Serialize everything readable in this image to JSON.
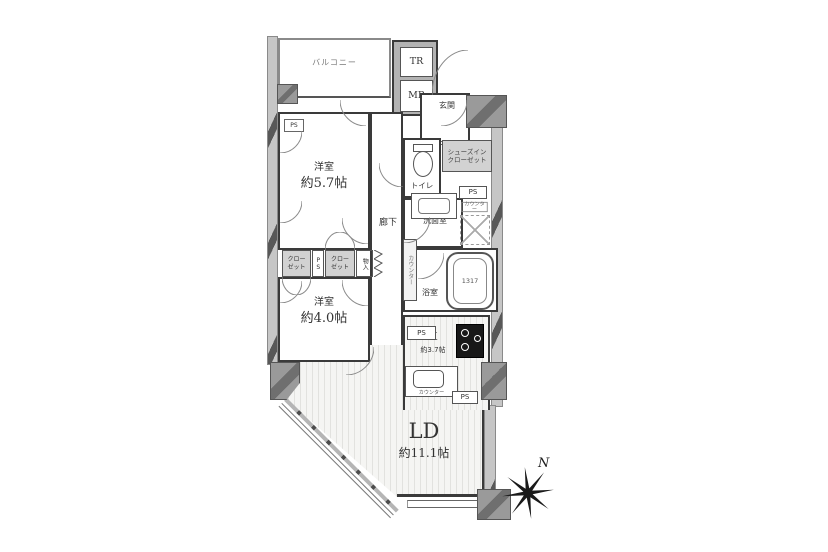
{
  "colors": {
    "wall_light": "#c6c6c6",
    "wall_dark": "#585858",
    "column": "#9a9a9a",
    "closet": "#d2d2d2",
    "line": "#3a3a3a"
  },
  "rooms": {
    "balcony": {
      "label": "バルコニー"
    },
    "shaft": {
      "tr": "TR",
      "mb": "MB"
    },
    "entrance": {
      "label": "玄関"
    },
    "toilet": {
      "label": "トイレ"
    },
    "shoes_in_closet": {
      "label": "シューズイン\nクローゼット"
    },
    "washroom": {
      "label": "洗面室",
      "counter": "カウンター"
    },
    "bathroom": {
      "label": "浴室",
      "tub_size": "1317",
      "side_counter": "カウンター"
    },
    "hallway": {
      "label": "廊下"
    },
    "bedroom1": {
      "label": "洋室",
      "size": "約5.7帖"
    },
    "bedroom2": {
      "label": "洋室",
      "size": "約4.0帖"
    },
    "closet_left": {
      "label": "クロー\nゼット"
    },
    "closet_right": {
      "label": "クロー\nゼット"
    },
    "storage": {
      "label": "物入"
    },
    "kitchen": {
      "label": "K",
      "size": "約3.7帖",
      "counter": "カウンター"
    },
    "living_dining": {
      "label": "LD",
      "size": "約11.1帖"
    }
  },
  "labels": {
    "ps": "PS"
  },
  "compass": {
    "north": "N"
  }
}
